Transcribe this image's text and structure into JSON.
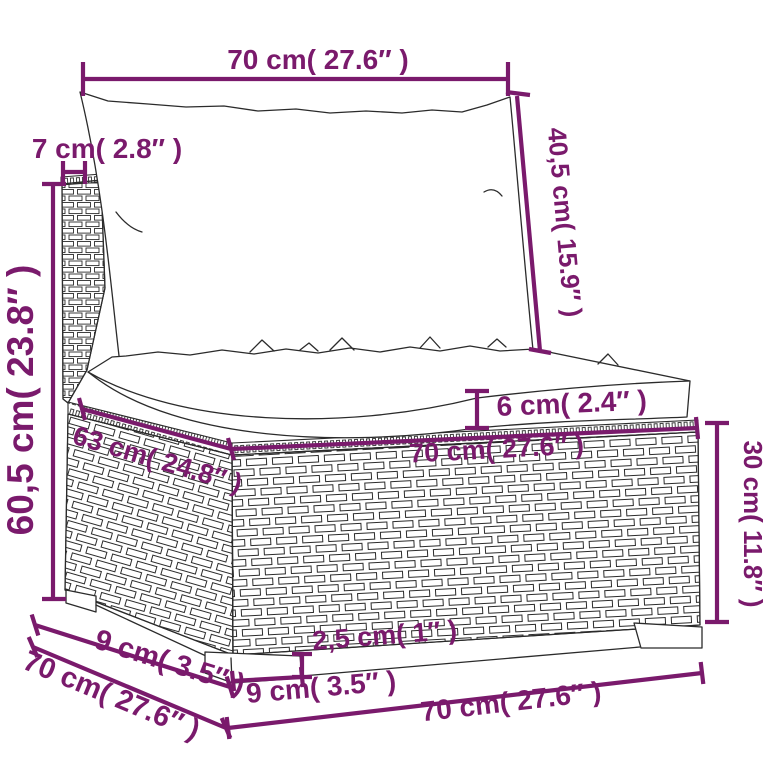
{
  "diagram": {
    "kind": "furniture-dimension-diagram",
    "subject": "poly rattan modular sofa middle section with cushions",
    "colors": {
      "dimension_accent": "#7A1A6C",
      "line_art": "#2b2b2b",
      "background": "#ffffff"
    },
    "dimensions": {
      "top_width": "70 cm( 27.6″ )",
      "back_thickness": "7 cm( 2.8″ )",
      "back_cushion_height": "40,5 cm( 15.9″ )",
      "total_height": "60,5 cm( 23.8″ )",
      "seat_cushion_thickness": "6 cm( 2.4″ )",
      "seat_depth_top": "63 cm( 24.8″ )",
      "seat_width_front": "70 cm( 27.6″ )",
      "base_height": "30 cm( 11.8″ )",
      "leg_inset_depth": "9 cm( 3.5″ )",
      "base_depth": "70 cm( 27.6″ )",
      "leg_height": "2,5 cm( 1″ )",
      "leg_width": "9 cm( 3.5″ )",
      "base_width": "70 cm( 27.6″ )"
    }
  }
}
